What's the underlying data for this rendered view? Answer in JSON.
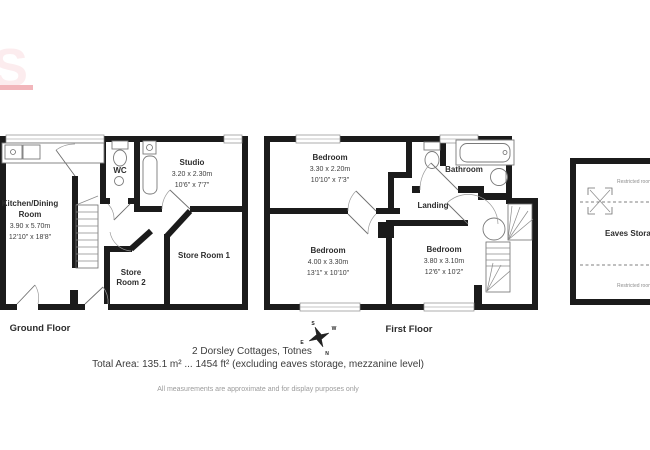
{
  "branding": {
    "watermark_letter": "S",
    "accent_bar_color": "#f2b6bb"
  },
  "plan": {
    "ground_floor": {
      "label": "Ground Floor",
      "kitchen": {
        "line1": "Kitchen/Dining",
        "line2": "Room",
        "metric": "3.90 x 5.70m",
        "imperial": "12'10\" x 18'8\""
      },
      "wc": {
        "name": "WC"
      },
      "studio": {
        "name": "Studio",
        "metric": "3.20 x 2.30m",
        "imperial": "10'6\" x 7'7\""
      },
      "store_room_1": {
        "name": "Store Room 1"
      },
      "store_room_2": {
        "line1": "Store",
        "line2": "Room 2"
      }
    },
    "first_floor": {
      "label": "First Floor",
      "bedroom_top": {
        "name": "Bedroom",
        "metric": "3.30 x 2.20m",
        "imperial": "10'10\" x 7'3\""
      },
      "bathroom": {
        "name": "Bathroom"
      },
      "landing": {
        "name": "Landing"
      },
      "bedroom_left": {
        "name": "Bedroom",
        "metric": "4.00 x 3.30m",
        "imperial": "13'1\" x 10'10\""
      },
      "bedroom_right": {
        "name": "Bedroom",
        "metric": "3.80 x 3.10m",
        "imperial": "12'6\" x 10'2\""
      }
    },
    "eaves": {
      "label": "Eaves Storage",
      "restricted_top": "Restricted room height",
      "restricted_bottom": "Restricted room height"
    }
  },
  "compass": {
    "north": "N",
    "south": "S",
    "east": "E",
    "west": "W"
  },
  "footer": {
    "address": "2 Dorsley Cottages, Totnes",
    "total_area": "Total Area: 135.1 m² ... 1454 ft² (excluding eaves storage, mezzanine level)",
    "disclaimer": "All measurements are approximate and for display purposes only"
  }
}
